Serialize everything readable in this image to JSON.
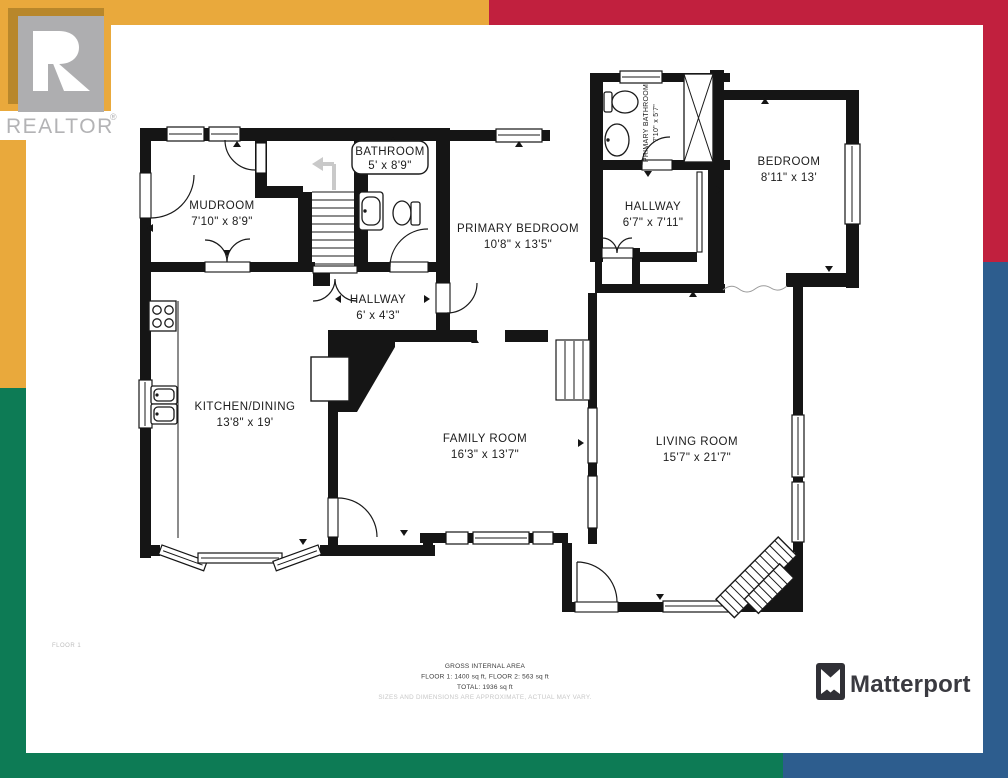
{
  "frame": {
    "gold": "#E9A93C",
    "gold_dark": "#B8872B",
    "red": "#C1203E",
    "green": "#0D7B55",
    "blue": "#2D5D8E",
    "white": "#FFFFFF"
  },
  "branding": {
    "realtor": {
      "logo_letter": "R",
      "wordmark": "REALTOR",
      "registered_mark": "®",
      "logo_gray": "#AEAEB0"
    },
    "matterport": {
      "wordmark": "Matterport"
    }
  },
  "plan": {
    "floor_tag": "FLOOR 1",
    "rooms": {
      "mudroom": {
        "name": "MUDROOM",
        "dims": "7'10\" x 8'9\""
      },
      "bathroom": {
        "name": "BATHROOM",
        "dims": "5' x 8'9\""
      },
      "primary_bedroom": {
        "name": "PRIMARY BEDROOM",
        "dims": "10'8\" x 13'5\""
      },
      "primary_bathroom": {
        "name": "PRIMARY BATHROOM",
        "dims": "7'10\" x 5'7\""
      },
      "hallway_upper": {
        "name": "HALLWAY",
        "dims": "6'7\" x 7'11\""
      },
      "bedroom": {
        "name": "BEDROOM",
        "dims": "8'11\" x 13'"
      },
      "hallway_lower": {
        "name": "HALLWAY",
        "dims": "6' x 4'3\""
      },
      "kitchen_dining": {
        "name": "KITCHEN/DINING",
        "dims": "13'8\" x 19'"
      },
      "family_room": {
        "name": "FAMILY ROOM",
        "dims": "16'3\" x 13'7\""
      },
      "living_room": {
        "name": "LIVING ROOM",
        "dims": "15'7\" x 21'7\""
      }
    }
  },
  "footer": {
    "title": "GROSS INTERNAL AREA",
    "line1": "FLOOR 1: 1400 sq ft, FLOOR 2: 563 sq ft",
    "line2": "TOTAL: 1936 sq ft",
    "disclaimer": "SIZES AND DIMENSIONS ARE APPROXIMATE, ACTUAL MAY VARY."
  }
}
